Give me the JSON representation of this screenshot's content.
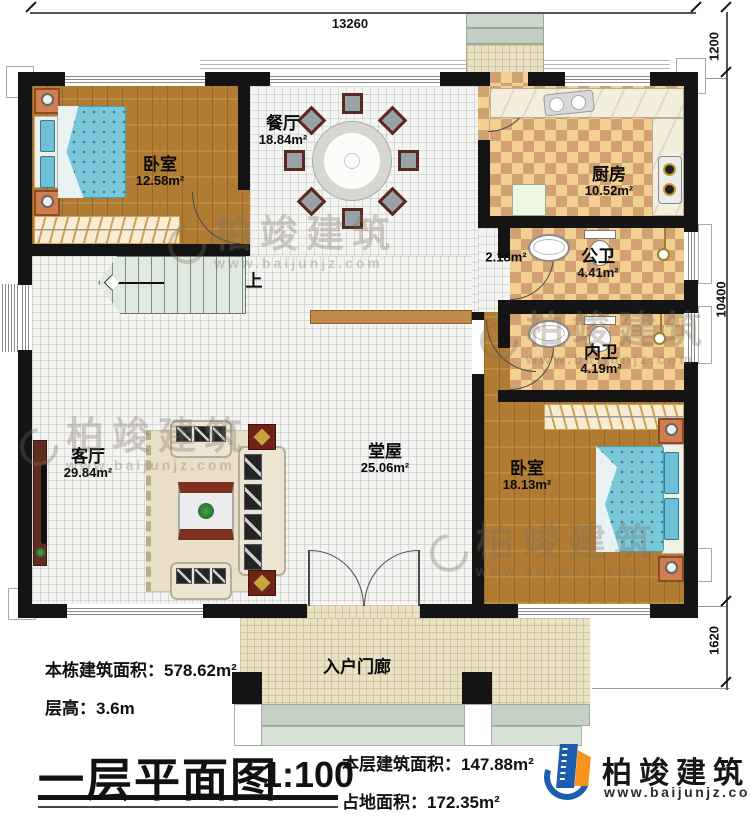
{
  "drawing": {
    "plan_title": "一层平面图",
    "scale": "1:100",
    "stats": {
      "building_total_area": "本栋建筑面积：578.62m²",
      "floor_height": "层高：3.6m",
      "floor_area": "本层建筑面积：147.88m²",
      "footprint_area": "占地面积：172.35m²"
    }
  },
  "dimensions": {
    "top_width": "13260",
    "right_back_depth": "1200",
    "right_height": "10400",
    "right_porch_depth": "1620"
  },
  "rooms": {
    "bedroom1": {
      "name": "卧室",
      "area": "12.58m²"
    },
    "dining": {
      "name": "餐厅",
      "area": "18.84m²"
    },
    "kitchen": {
      "name": "厨房",
      "area": "10.52m²"
    },
    "public_bath": {
      "name": "公卫",
      "area": "4.41m²"
    },
    "inner_bath": {
      "name": "内卫",
      "area": "4.19m²"
    },
    "hall": {
      "name": "堂屋",
      "area": "25.06m²"
    },
    "living": {
      "name": "客厅",
      "area": "29.84m²"
    },
    "bedroom2": {
      "name": "卧室",
      "area": "18.13m²"
    },
    "porch": {
      "name": "入户门廊"
    },
    "hallway": {
      "area": "2.18m²"
    },
    "stairs": {
      "up_label": "上"
    }
  },
  "branding": {
    "company": "柏竣建筑",
    "website": "www.baijunjz.com"
  },
  "colors": {
    "wall": "#141414",
    "wood_floor": "#b07c34",
    "tile_light": "#f2d092",
    "tile_dark": "#d2a173",
    "bed_blue": "#7ac7da",
    "logo_blue": "#1e5cae",
    "logo_orange": "#f7941d"
  }
}
